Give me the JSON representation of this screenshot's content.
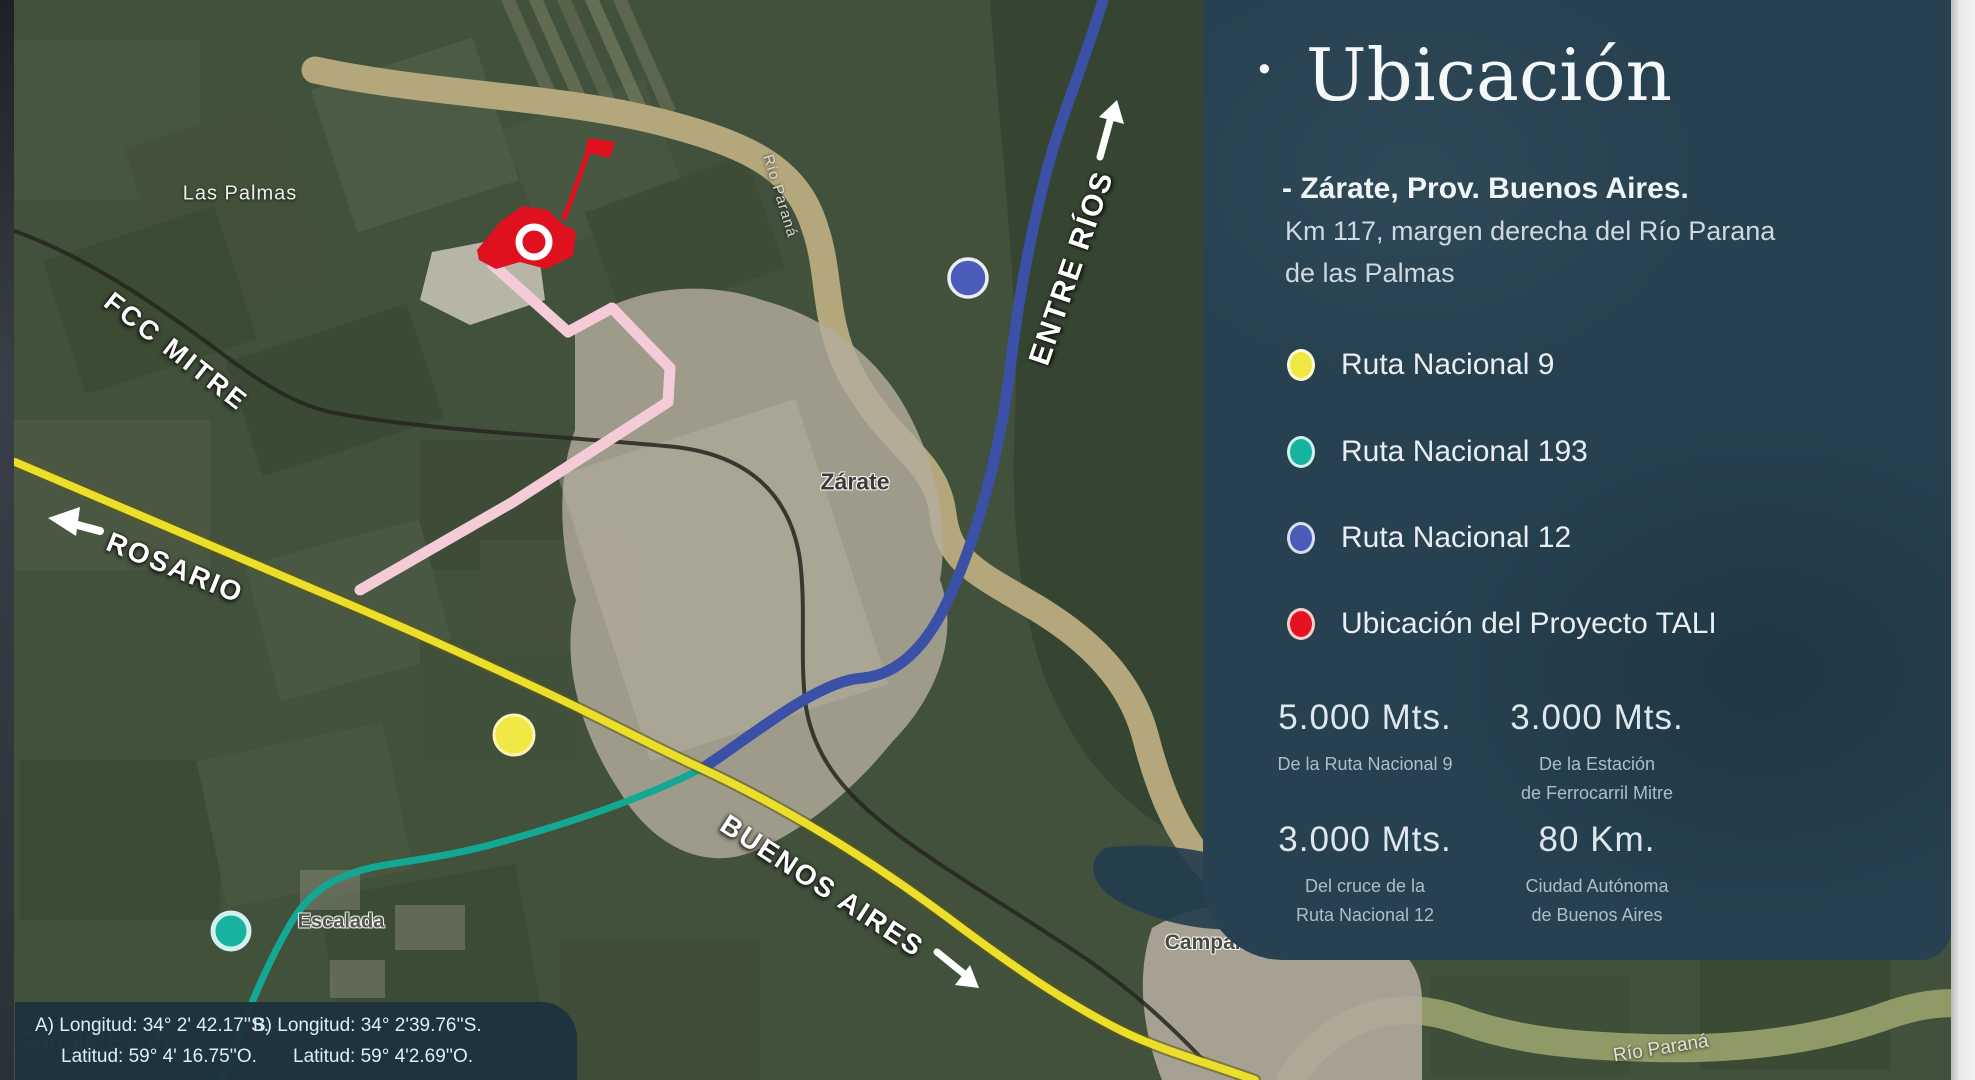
{
  "panel": {
    "bullet": "·",
    "title": "Ubicación",
    "subtitle": "- Zárate, Prov. Buenos Aires.",
    "detail_line1": "Km 117, margen derecha del Río Parana",
    "detail_line2": "de las Palmas",
    "legend": [
      {
        "label": "Ruta Nacional 9",
        "color": "#f2e845"
      },
      {
        "label": "Ruta Nacional 193",
        "color": "#16b3a1"
      },
      {
        "label": "Ruta Nacional 12",
        "color": "#4a5cb8"
      },
      {
        "label": "Ubicación del Proyecto TALI",
        "color": "#e5131f"
      }
    ],
    "stats": [
      {
        "value": "5.000 Mts.",
        "caption1": "De la Ruta Nacional 9",
        "caption2": ""
      },
      {
        "value": "3.000 Mts.",
        "caption1": "De la Estación",
        "caption2": "de Ferrocarril Mitre"
      },
      {
        "value": "3.000 Mts.",
        "caption1": "Del cruce de la",
        "caption2": "Ruta Nacional 12"
      },
      {
        "value": "80 Km.",
        "caption1": "Ciudad Autónoma",
        "caption2": "de Buenos Aires"
      }
    ]
  },
  "map": {
    "labels": {
      "las_palmas": "Las Palmas",
      "fcc_mitre": "FCC MITRE",
      "rosario": "ROSARIO",
      "entre_rios": "ENTRE RÍOS",
      "buenos_aires": "BUENOS AIRES",
      "zarate": "Zárate",
      "escalada": "Escalada",
      "campana": "Campana",
      "rio_parana_top": "Río Paraná",
      "rio_parana_bottom": "Río Paraná"
    },
    "watermark": "Google Earth"
  },
  "coords": {
    "a_line1": "A) Longitud: 34° 2' 42.17''S.",
    "a_line2": "Latitud: 59° 4' 16.75''O.",
    "b_line1": "B) Longitud: 34° 2'39.76''S.",
    "b_line2": "Latitud: 59° 4'2.69''O."
  },
  "colors": {
    "panel_bg": "#274150",
    "route9": "#ecdf2b",
    "route193": "#12a893",
    "route12": "#3b51a8",
    "pink_route": "#f6cbd8",
    "project_red": "#e0111f",
    "river": "#b4a77c"
  }
}
